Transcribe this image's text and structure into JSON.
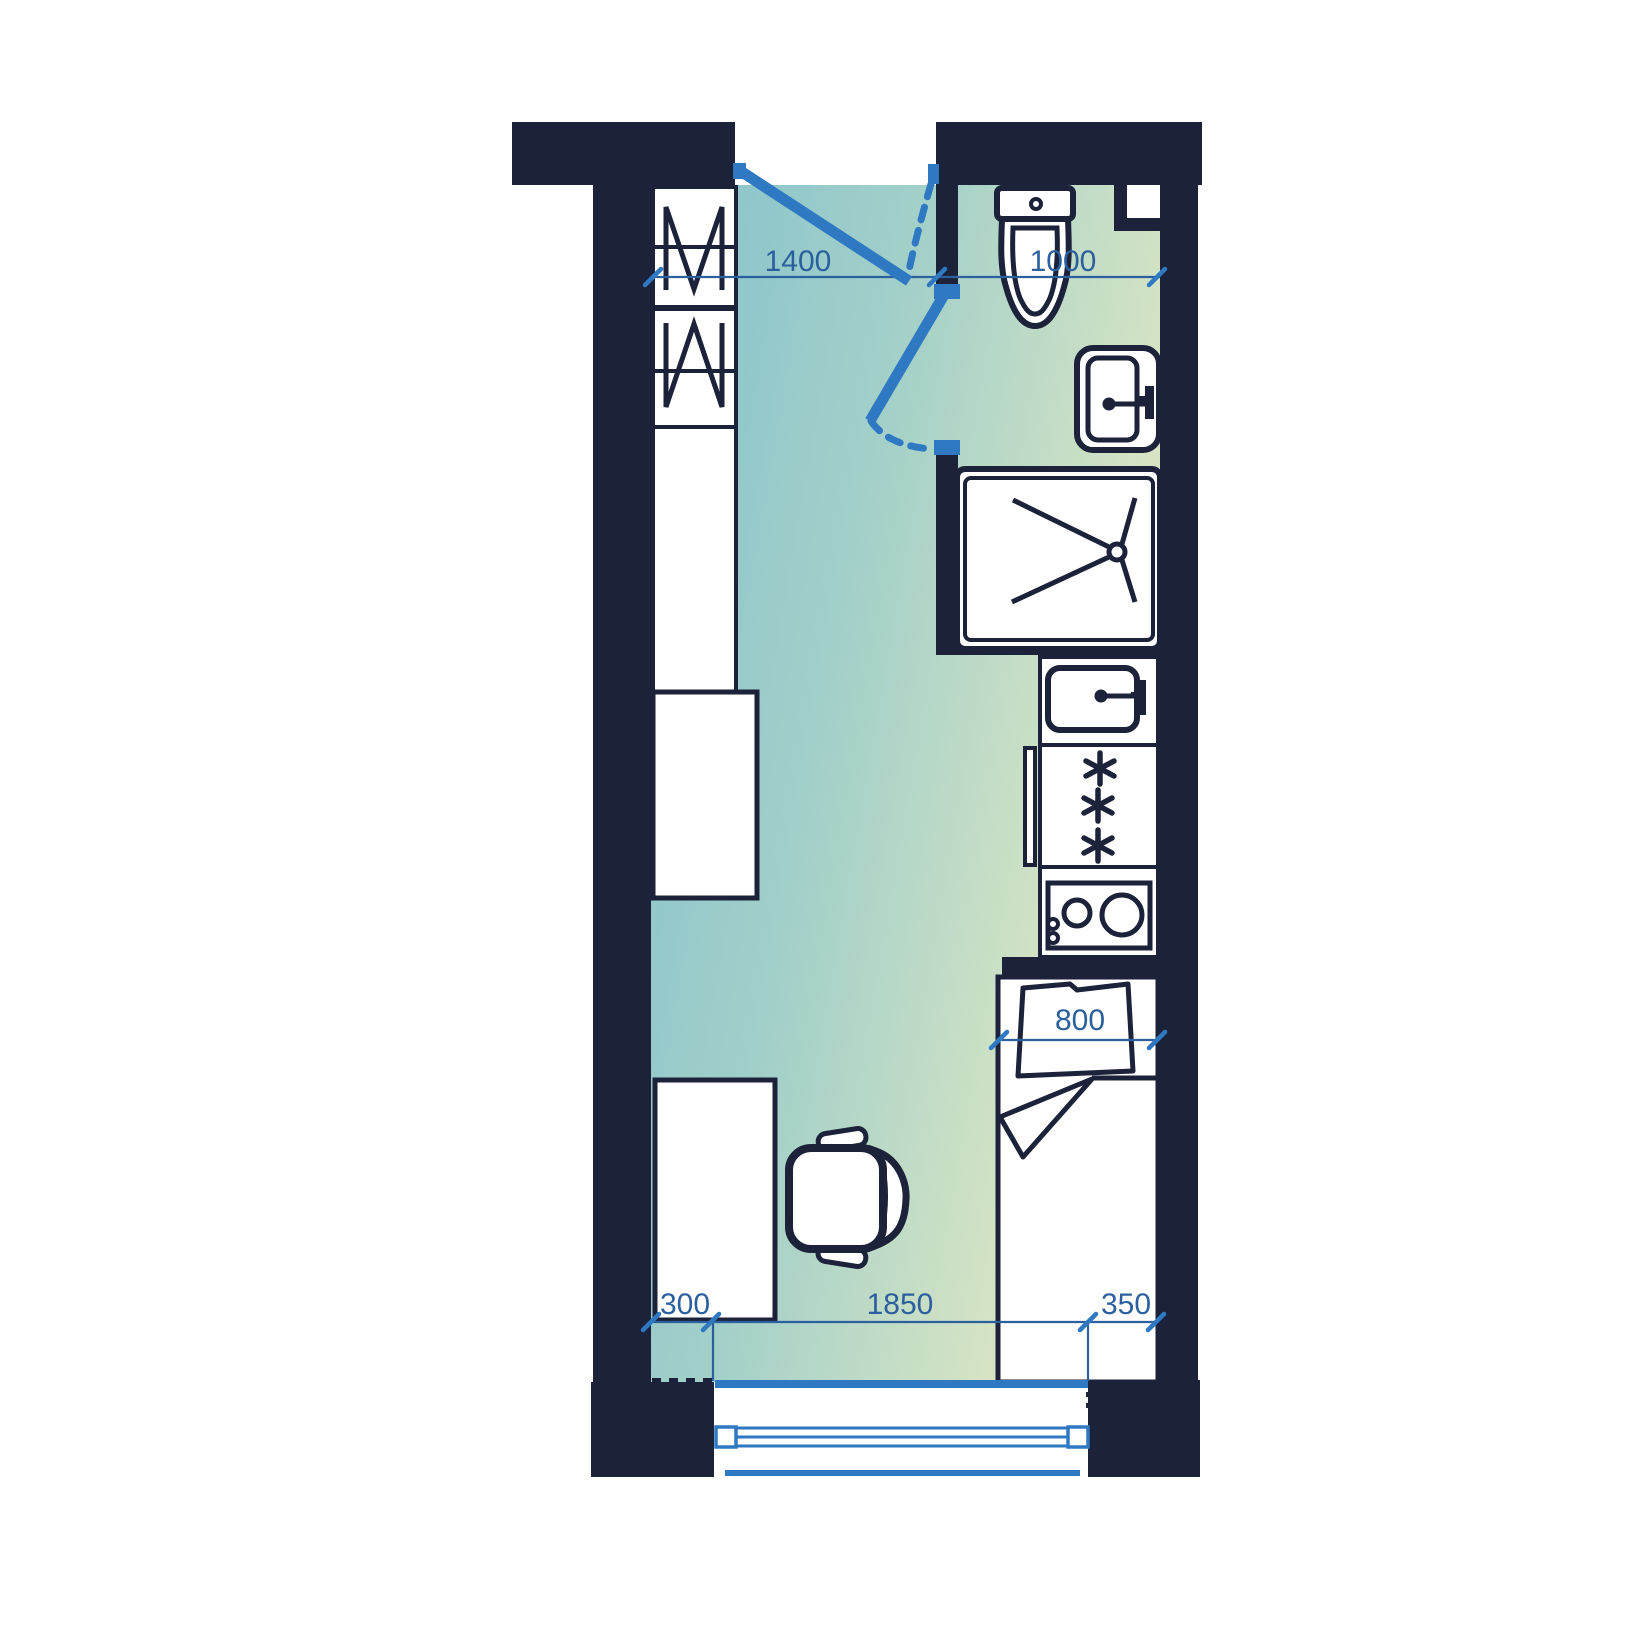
{
  "plan": {
    "type": "studio-apartment-floor-plan",
    "dimensions_mm": {
      "entry_zone_width": "1400",
      "bathroom_width": "1000",
      "bed_width": "800",
      "left_segment": "300",
      "window_width": "1850",
      "right_segment": "350"
    },
    "fixtures": [
      "wardrobe",
      "storage-cabinet",
      "counter-unit",
      "desk",
      "office-chair",
      "toilet",
      "washbasin",
      "shower",
      "kitchen-sink",
      "refrigerator",
      "cooktop",
      "bed",
      "pillow",
      "blanket",
      "entrance-door",
      "bathroom-door",
      "window",
      "balcony-edge",
      "duct-niche"
    ]
  },
  "colors": {
    "wall": "#1b2239",
    "accent": "#2e79c2",
    "dim": "#2b5f9e",
    "floor_left": "#85c2cc",
    "floor_mid": "#a3d0c9",
    "floor_right": "#d6e4c4",
    "floor_edge": "#dde8cb"
  }
}
